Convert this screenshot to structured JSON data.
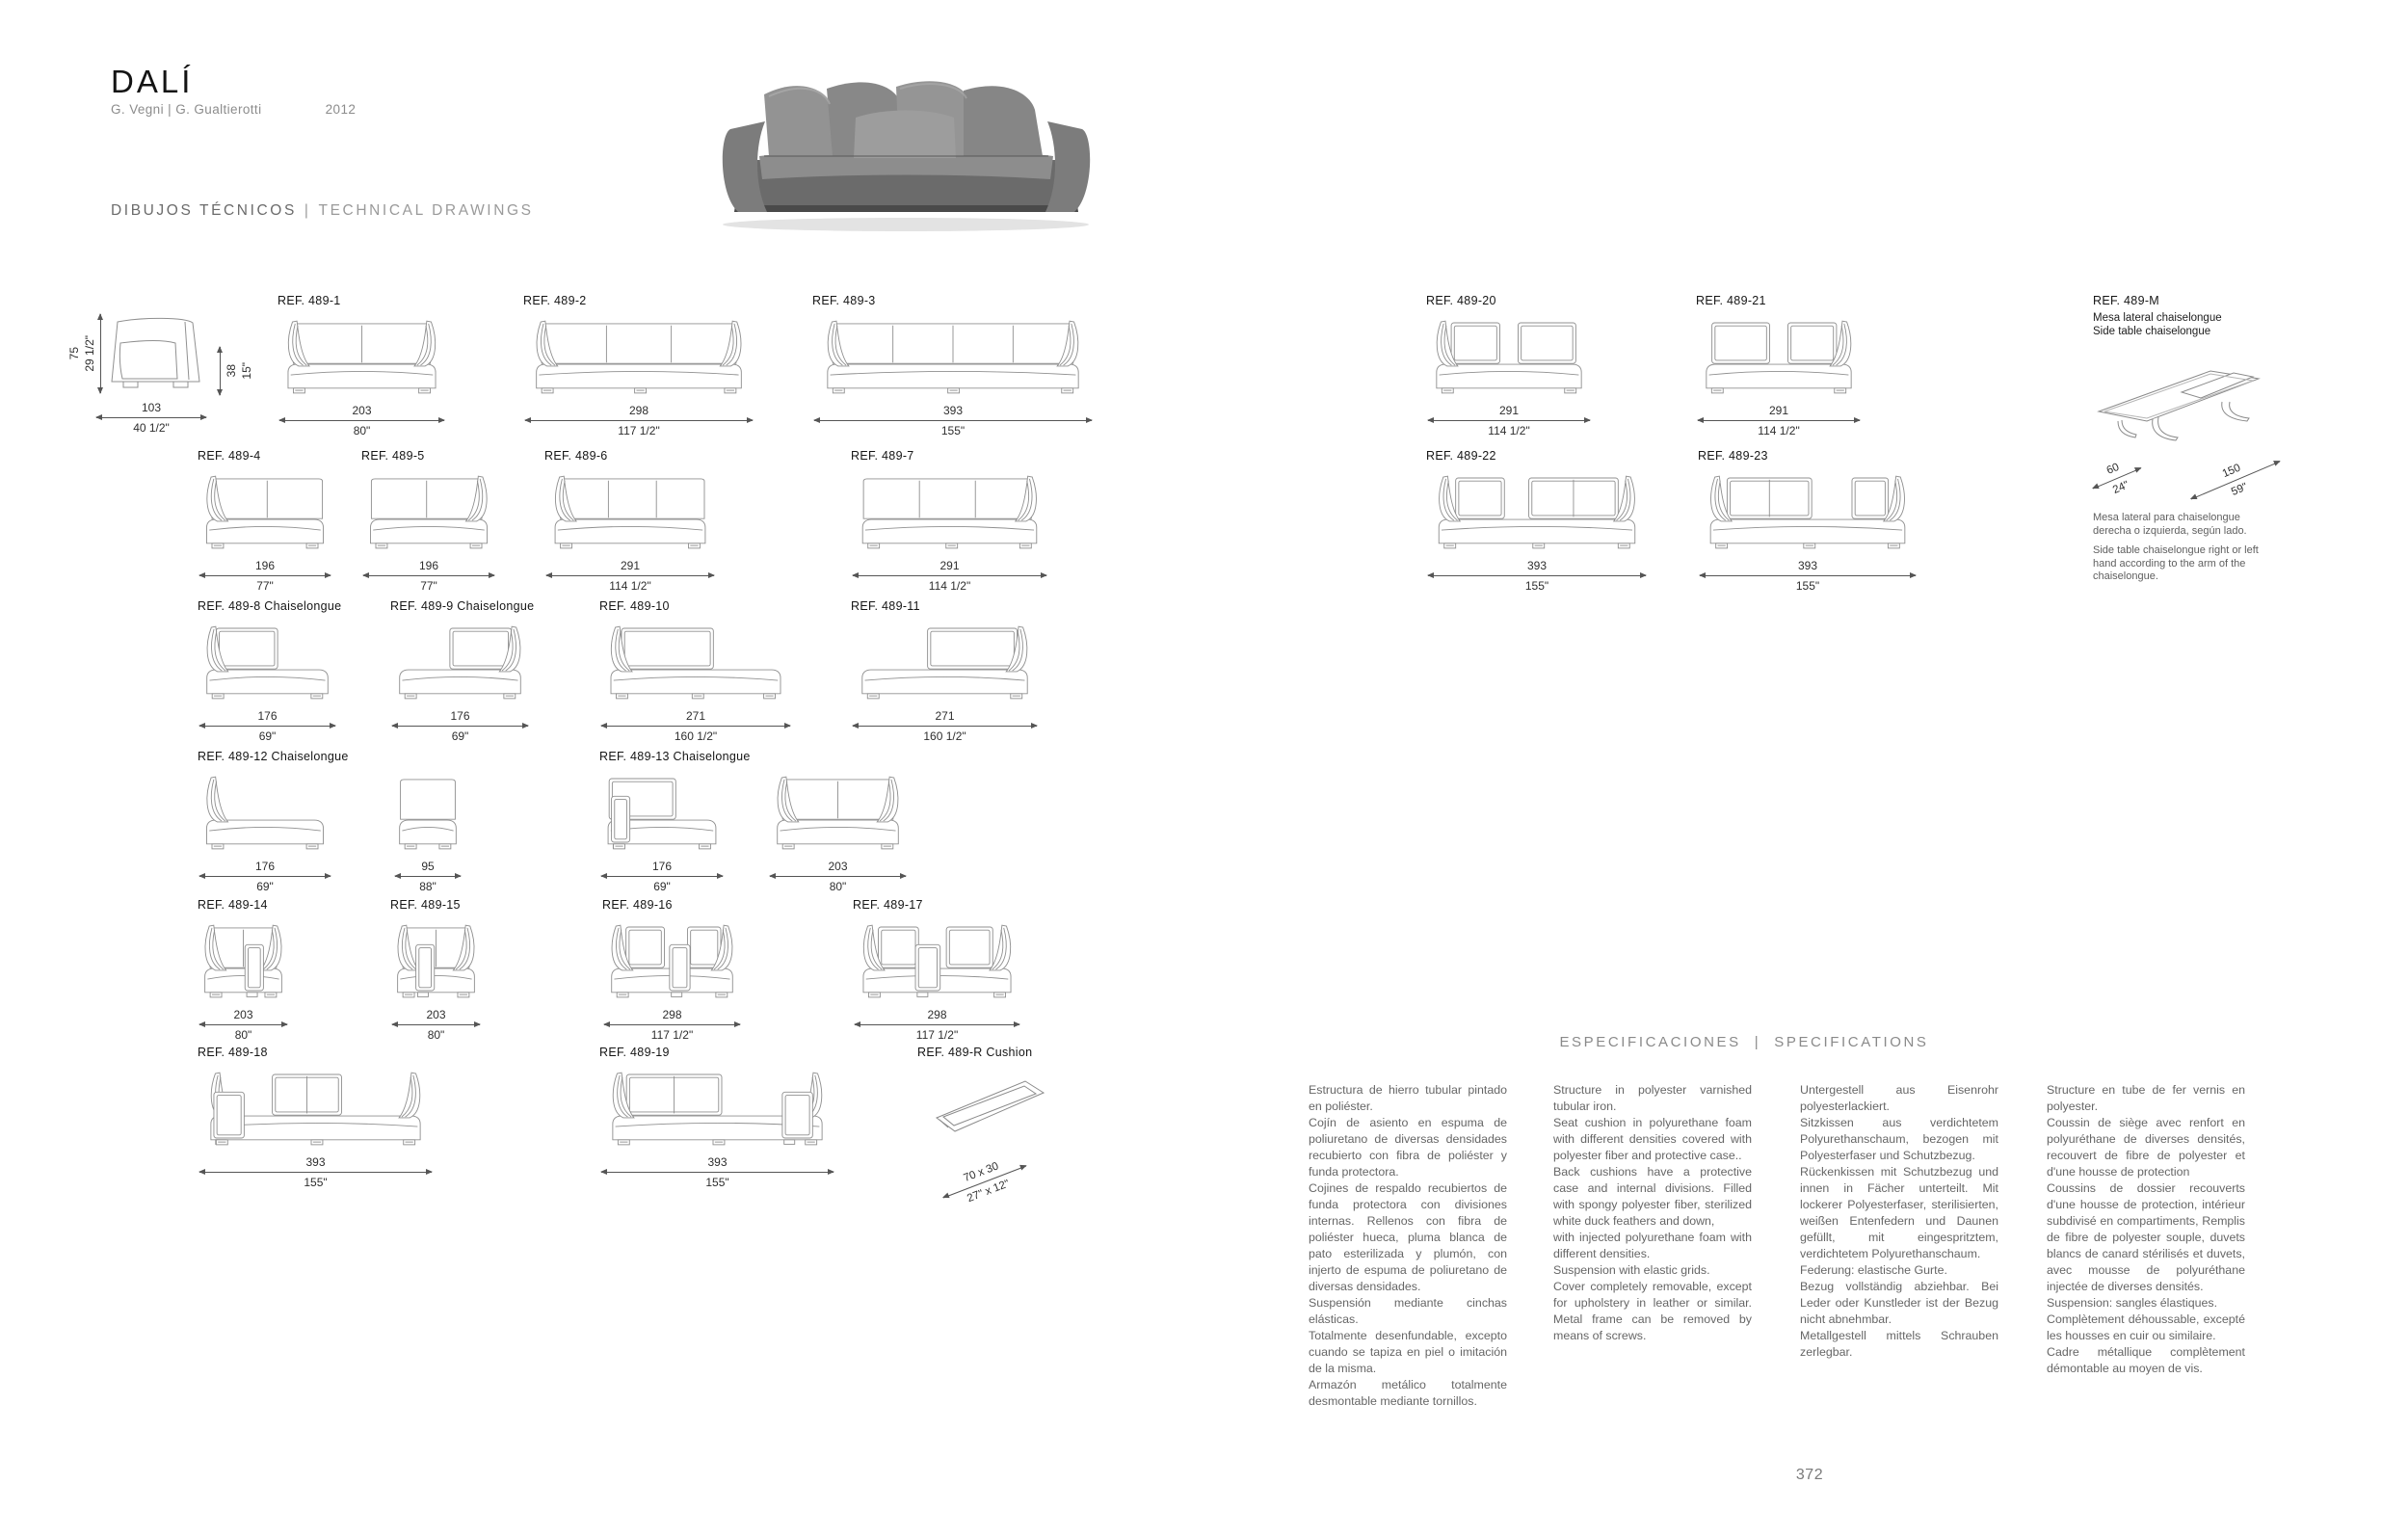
{
  "header": {
    "title": "DALÍ",
    "designers": "G. Vegni | G. Gualtierotti",
    "year": "2012",
    "section_heading_es": "DIBUJOS TÉCNICOS",
    "section_heading_sep": "|",
    "section_heading_en": "TECHNICAL DRAWINGS"
  },
  "side_view": {
    "height_cm": "75",
    "height_in": "29 1/2\"",
    "depth_cm": "103",
    "depth_in": "40 1/2\"",
    "seat_height_cm": "38",
    "seat_height_in": "15\""
  },
  "drawings": [
    {
      "id": "489-1",
      "ref": "REF. 489-1",
      "cm": "203",
      "in": "80\"",
      "arms": "both",
      "back_divs": 1
    },
    {
      "id": "489-2",
      "ref": "REF. 489-2",
      "cm": "298",
      "in": "117 1/2\"",
      "arms": "both",
      "back_divs": 2
    },
    {
      "id": "489-3",
      "ref": "REF. 489-3",
      "cm": "393",
      "in": "155\"",
      "arms": "both",
      "back_divs": 3
    },
    {
      "id": "489-4",
      "ref": "REF. 489-4",
      "cm": "196",
      "in": "77\"",
      "arms": "left",
      "back_divs": 1
    },
    {
      "id": "489-5",
      "ref": "REF. 489-5",
      "cm": "196",
      "in": "77\"",
      "arms": "right",
      "back_divs": 1
    },
    {
      "id": "489-6",
      "ref": "REF. 489-6",
      "cm": "291",
      "in": "114 1/2\"",
      "arms": "left",
      "back_divs": 2
    },
    {
      "id": "489-7",
      "ref": "REF. 489-7",
      "cm": "291",
      "in": "114 1/2\"",
      "arms": "right",
      "back_divs": 2
    },
    {
      "id": "489-8",
      "ref": "REF. 489-8 Chaiselongue",
      "cm": "176",
      "in": "69\"",
      "arms": "left",
      "segs": [
        [
          0.1,
          0.58
        ]
      ]
    },
    {
      "id": "489-9",
      "ref": "REF. 489-9 Chaiselongue",
      "cm": "176",
      "in": "69\"",
      "arms": "right",
      "segs": [
        [
          0.42,
          0.9
        ]
      ]
    },
    {
      "id": "489-10",
      "ref": "REF. 489-10",
      "cm": "271",
      "in": "160 1/2\"",
      "arms": "left",
      "segs": [
        [
          0.08,
          0.6
        ]
      ]
    },
    {
      "id": "489-11",
      "ref": "REF. 489-11",
      "cm": "271",
      "in": "160 1/2\"",
      "arms": "right",
      "segs": [
        [
          0.4,
          0.92
        ]
      ]
    },
    {
      "id": "489-12",
      "ref": "REF. 489-12 Chaiselongue",
      "cm": "176",
      "in": "69\"",
      "arms": "left"
    },
    {
      "id": "489-12b",
      "ref": "",
      "cm": "95",
      "in": "88\"",
      "arms": "none",
      "back_divs": 0
    },
    {
      "id": "489-13",
      "ref": "REF. 489-13 Chaiselongue",
      "cm": "176",
      "in": "69\"",
      "arms": "none",
      "segs": [
        [
          0.04,
          0.62
        ]
      ],
      "fronts": [
        [
          0.06,
          0.22
        ]
      ]
    },
    {
      "id": "489-13b",
      "ref": "",
      "cm": "203",
      "in": "80\"",
      "arms": "both",
      "back_divs": 1
    },
    {
      "id": "489-14",
      "ref": "REF. 489-14",
      "cm": "203",
      "in": "80\"",
      "arms": "both",
      "back_divs": 1,
      "fronts": [
        [
          0.52,
          0.74
        ]
      ]
    },
    {
      "id": "489-15",
      "ref": "REF. 489-15",
      "cm": "203",
      "in": "80\"",
      "arms": "both",
      "back_divs": 1,
      "fronts": [
        [
          0.26,
          0.48
        ]
      ]
    },
    {
      "id": "489-16",
      "ref": "REF. 489-16",
      "cm": "298",
      "in": "117 1/2\"",
      "arms": "both",
      "segs": [
        [
          0.14,
          0.44
        ],
        [
          0.62,
          0.88
        ]
      ],
      "fronts": [
        [
          0.48,
          0.64
        ]
      ]
    },
    {
      "id": "489-17",
      "ref": "REF. 489-17",
      "cm": "298",
      "in": "117 1/2\"",
      "arms": "both",
      "segs": [
        [
          0.12,
          0.38
        ],
        [
          0.56,
          0.86
        ]
      ],
      "fronts": [
        [
          0.36,
          0.52
        ]
      ]
    },
    {
      "id": "489-18",
      "ref": "REF. 489-18",
      "cm": "393",
      "in": "155\"",
      "arms": "both",
      "segs": [
        [
          0.3,
          0.62,
          [
            0.46
          ]
        ]
      ],
      "fronts": [
        [
          0.03,
          0.17
        ]
      ]
    },
    {
      "id": "489-19",
      "ref": "REF. 489-19",
      "cm": "393",
      "in": "155\"",
      "arms": "both",
      "segs": [
        [
          0.08,
          0.52,
          [
            0.3
          ]
        ]
      ],
      "fronts": [
        [
          0.8,
          0.94
        ]
      ]
    },
    {
      "id": "489-20",
      "ref": "REF. 489-20",
      "cm": "291",
      "in": "114 1/2\"",
      "arms": "left",
      "segs": [
        [
          0.12,
          0.44
        ],
        [
          0.56,
          0.94
        ]
      ]
    },
    {
      "id": "489-21",
      "ref": "REF. 489-21",
      "cm": "291",
      "in": "114 1/2\"",
      "arms": "right",
      "segs": [
        [
          0.06,
          0.44
        ],
        [
          0.56,
          0.88
        ]
      ]
    },
    {
      "id": "489-22",
      "ref": "REF. 489-22",
      "cm": "393",
      "in": "155\"",
      "arms": "both",
      "segs": [
        [
          0.1,
          0.34
        ],
        [
          0.46,
          0.9,
          [
            0.68
          ]
        ]
      ]
    },
    {
      "id": "489-23",
      "ref": "REF. 489-23",
      "cm": "393",
      "in": "155\"",
      "arms": "both",
      "segs": [
        [
          0.1,
          0.52,
          [
            0.31
          ]
        ],
        [
          0.72,
          0.9
        ]
      ]
    }
  ],
  "side_table": {
    "ref": "REF. 489-M",
    "name_es": "Mesa lateral chaiselongue",
    "name_en": "Side table chaiselongue",
    "depth_cm": "60",
    "depth_in": "24\"",
    "length_cm": "150",
    "length_in": "59\"",
    "note_es": "Mesa lateral para chaiselongue derecha o izquierda, según lado.",
    "note_en": "Side table chaiselongue right or left hand according to the arm of the chaiselongue."
  },
  "cushion": {
    "ref": "REF. 489-R Cushion",
    "size_cm": "70 x 30",
    "size_in": "27\" x 12\""
  },
  "specs": {
    "heading_es": "ESPECIFICACIONES",
    "heading_sep": "|",
    "heading_en": "SPECIFICATIONS",
    "col_es": "Estructura de hierro tubular pintado en poliéster.\nCojín de asiento en espuma de poliuretano de diversas densidades recubierto con fibra de poliéster y funda protectora.\nCojines de respaldo recubiertos de funda protectora con divisiones internas. Rellenos con fibra de poliéster hueca, pluma blanca de pato esterilizada y plumón, con injerto de espuma de poliuretano de diversas densidades.\nSuspensión mediante cinchas elásticas.\nTotalmente desenfundable, excepto cuando se tapiza en piel o imitación de la misma.\nArmazón metálico totalmente desmontable mediante tornillos.",
    "col_en": "Structure in polyester varnished tubular iron.\nSeat cushion in polyurethane foam with different densities covered with polyester fiber and protective case..\nBack cushions have a protective case and internal divisions. Filled with spongy polyester fiber, sterilized white duck feathers and down,\nwith injected polyurethane foam with different densities.\nSuspension with elastic grids.\nCover completely removable, except for upholstery in leather or similar. Metal frame can be removed by means of screws.",
    "col_de": "Untergestell aus Eisenrohr polyesterlackiert.\nSitzkissen aus verdichtetem Polyurethanschaum, bezogen mit Polyesterfaser und Schutzbezug.\nRückenkissen mit Schutzbezug und innen in Fächer unterteilt. Mit lockerer Polyesterfaser, sterilisierten, weißen Entenfedern und Daunen gefüllt, mit eingespritztem, verdichtetem Polyurethanschaum.\nFederung: elastische Gurte.\nBezug vollständig abziehbar. Bei Leder oder Kunstleder ist der Bezug nicht abnehmbar.\nMetallgestell mittels Schrauben zerlegbar.",
    "col_fr": "Structure en tube de fer vernis en polyester.\nCoussin de siège avec renfort en polyuréthane de diverses densités, recouvert de fibre de polyester et d'une housse de protection\nCoussins de dossier recouverts d'une housse de protection, intérieur subdivisé en compartiments, Remplis de fibre de polyester souple, duvets blancs de canard stérilisés et duvets, avec mousse de polyuréthane injectée de diverses densités.\nSuspension: sangles élastiques.\nComplètement déhoussable, excepté les housses en cuir ou similaire.\nCadre métallique complètement démontable au moyen de vis."
  },
  "page_number": "372",
  "colors": {
    "line": "#909090",
    "dim": "#555555",
    "text": "#666666",
    "label": "#161616"
  }
}
